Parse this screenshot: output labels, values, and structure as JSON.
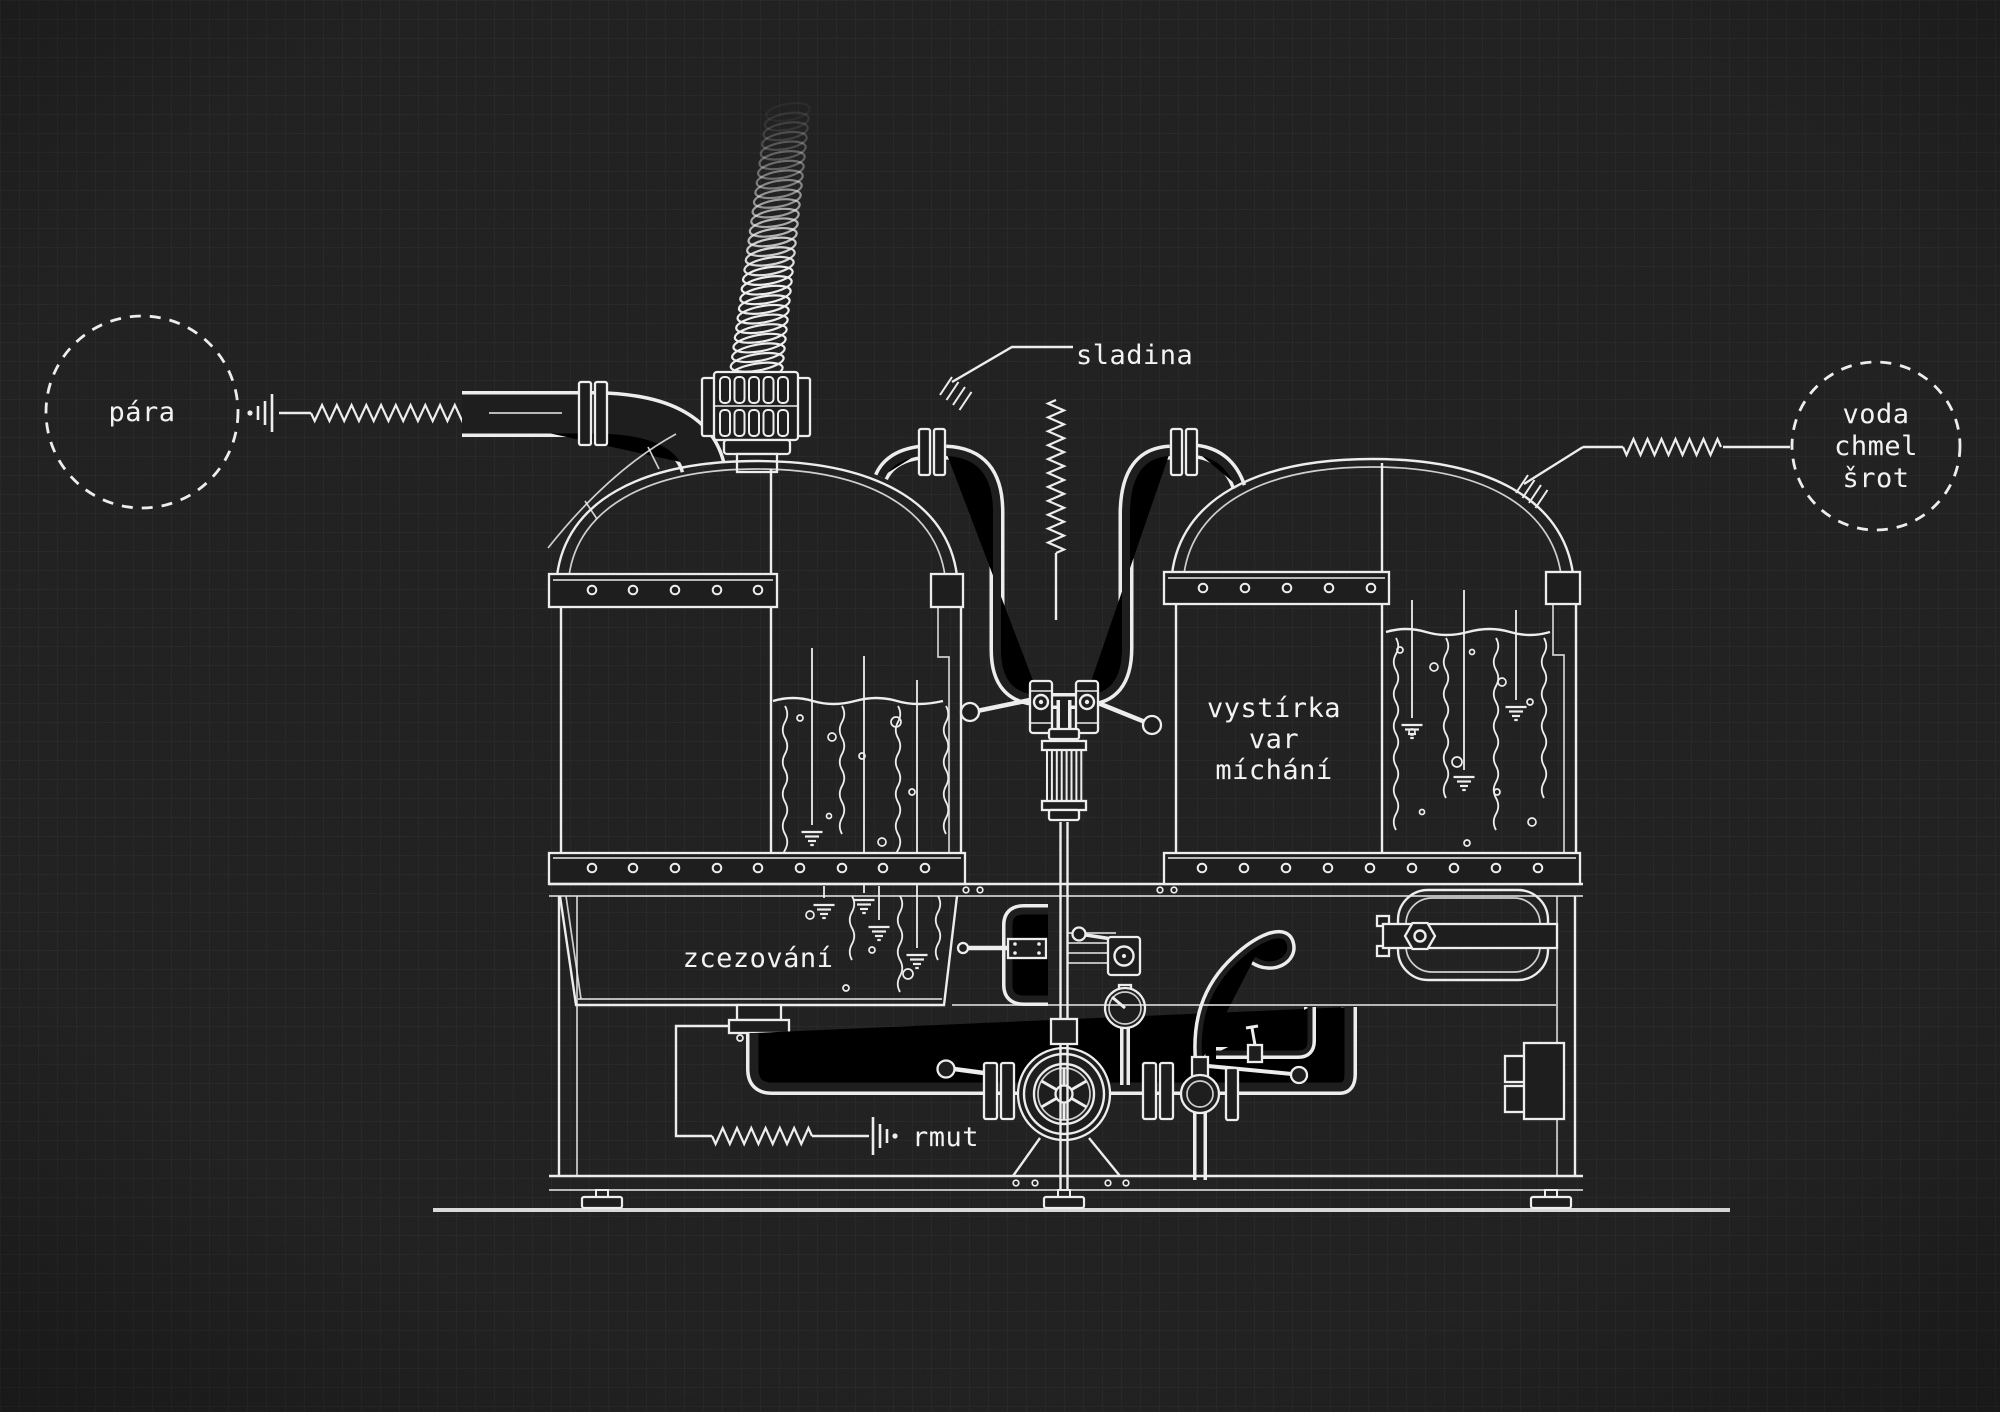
{
  "diagram": {
    "kind": "brewhouse process blueprint",
    "labels": {
      "steam": "pára",
      "wort": "sladina",
      "inputs": {
        "line1": "voda",
        "line2": "chmel",
        "line3": "šrot"
      },
      "kettle": {
        "line1": "vystírka",
        "line2": "var",
        "line3": "míchání"
      },
      "lautering": "zcezování",
      "mash": "rmut"
    },
    "colors": {
      "background": "#1e1e1e",
      "grid": "#2c2c2c",
      "line": "#ededed",
      "text": "#f3f3f3"
    }
  }
}
